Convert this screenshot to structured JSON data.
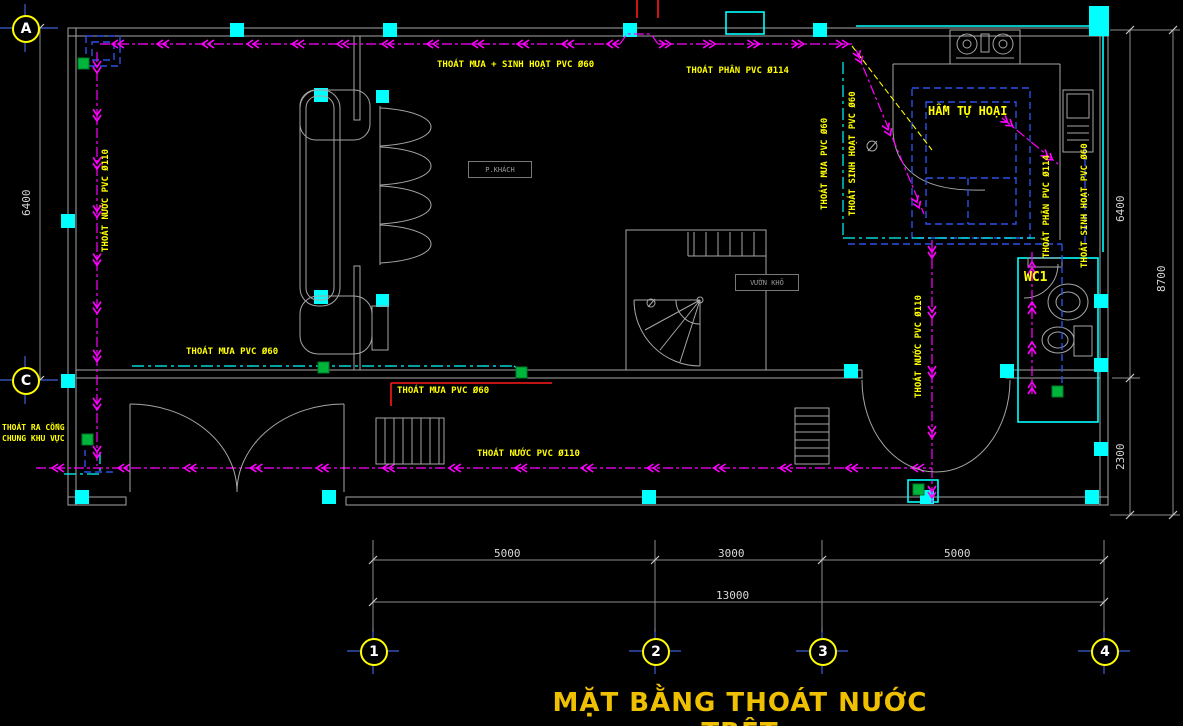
{
  "title": "MẶT BẰNG THOÁT NƯỚC TRỆT",
  "labels": {
    "rain_domestic_pvc60": "THOÁT MƯA + SINH HOẠT PVC Ø60",
    "soil_pvc114_top": "THOÁT PHÂN PVC Ø114",
    "septic_tank": "HẦM TỰ HOẠI",
    "wc1": "WC1",
    "living_room": "P.KHÁCH",
    "dry_yard": "VƯỜN KHÔ",
    "water_pvc110_left": "THOÁT NƯỚC PVC Ø110",
    "rain_pvc60_mid": "THOÁT MƯA PVC Ø60",
    "rain_pvc60_ramp": "THOÁT MƯA PVC Ø60",
    "water_pvc110_bottom": "THOÁT NƯỚC PVC Ø110",
    "to_public_sewer_1": "THOÁT RA CỐNG",
    "to_public_sewer_2": "CHUNG KHU VỰC",
    "rain_pvc60_right": "THOÁT MƯA PVC Ø60",
    "domestic_pvc60_right": "THOÁT SINH HOẠT PVC Ø60",
    "water_pvc110_right": "THOÁT NƯỚC PVC Ø110",
    "soil_pvc114_wc": "THOÁT PHÂN PVC Ø114",
    "domestic_pvc60_wc": "THOÁT SINH HOẠT PVC Ø60"
  },
  "bubbles": {
    "a": "A",
    "c": "C",
    "c1": "1",
    "c2": "2",
    "c3": "3",
    "c4": "4"
  },
  "dims": {
    "seg1": "5000",
    "seg2": "3000",
    "seg3": "5000",
    "total": "13000",
    "left_height": "6400",
    "right_upper": "6400",
    "right_lower": "2300",
    "right_total": "8700"
  },
  "colors": {
    "background": "#000000",
    "wall": "#a6a6a6",
    "label_yellow": "#ffff00",
    "title_yellow": "#efc000",
    "flow_magenta": "#ff00ff",
    "water_cyan": "#00ffff",
    "pipe_blue": "#2b50e8",
    "drain_green": "#00b53c",
    "dim_white": "#d9d9d9",
    "grid_blue": "#3c5fd6",
    "marker_red": "#ff1a1a"
  }
}
